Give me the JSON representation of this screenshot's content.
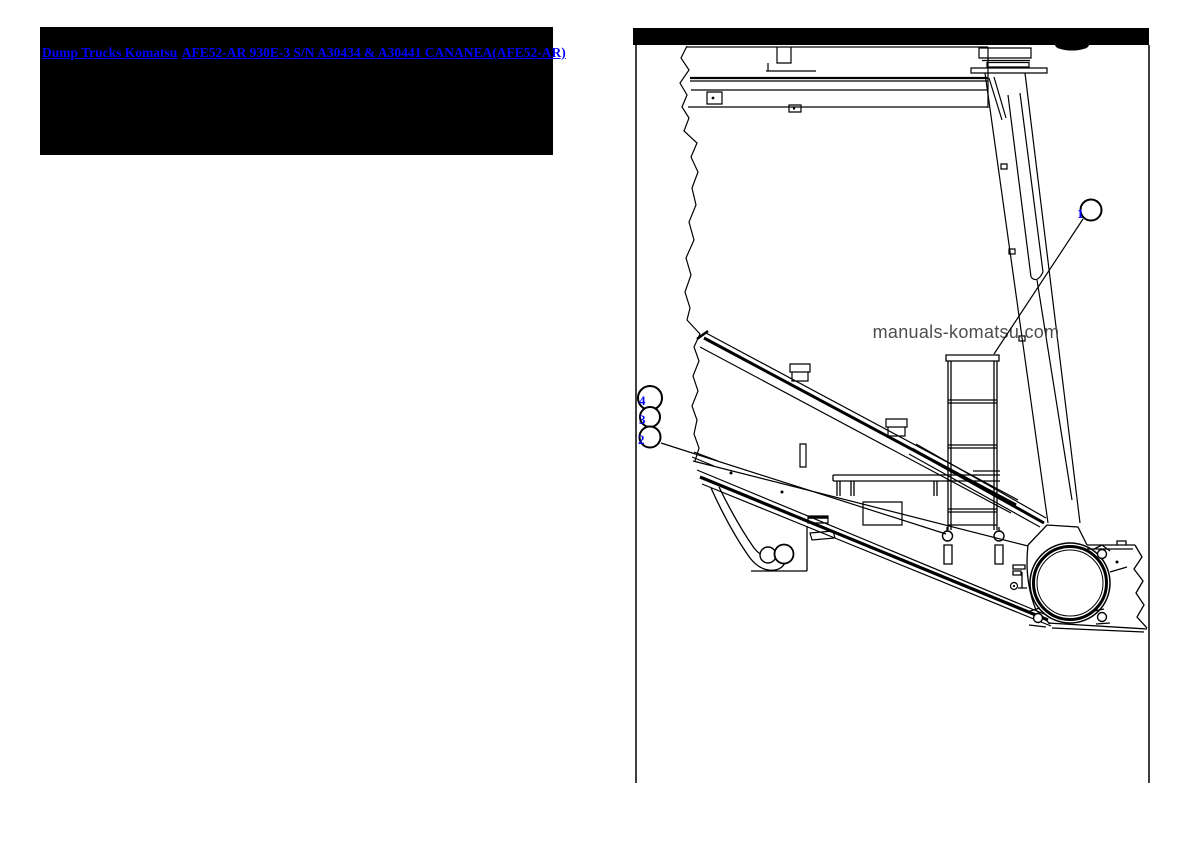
{
  "header_box": {
    "background": "#000000",
    "link_color": "#0000ff",
    "links": [
      {
        "label": "Dump Trucks Komatsu"
      },
      {
        "label": "AFE52-AR 930E-3 S/N A30434 & A30441 CANANEA(AFE52-AR)"
      }
    ]
  },
  "diagram": {
    "top_bar_color": "#000000",
    "line_color": "#000000",
    "watermark": "manuals-komatsu.com",
    "watermark_color": "#4d4d4d",
    "callout_color": "#0000ff",
    "callouts": [
      {
        "number": "1"
      },
      {
        "number": "4"
      },
      {
        "number": "3"
      },
      {
        "number": "2"
      }
    ]
  }
}
